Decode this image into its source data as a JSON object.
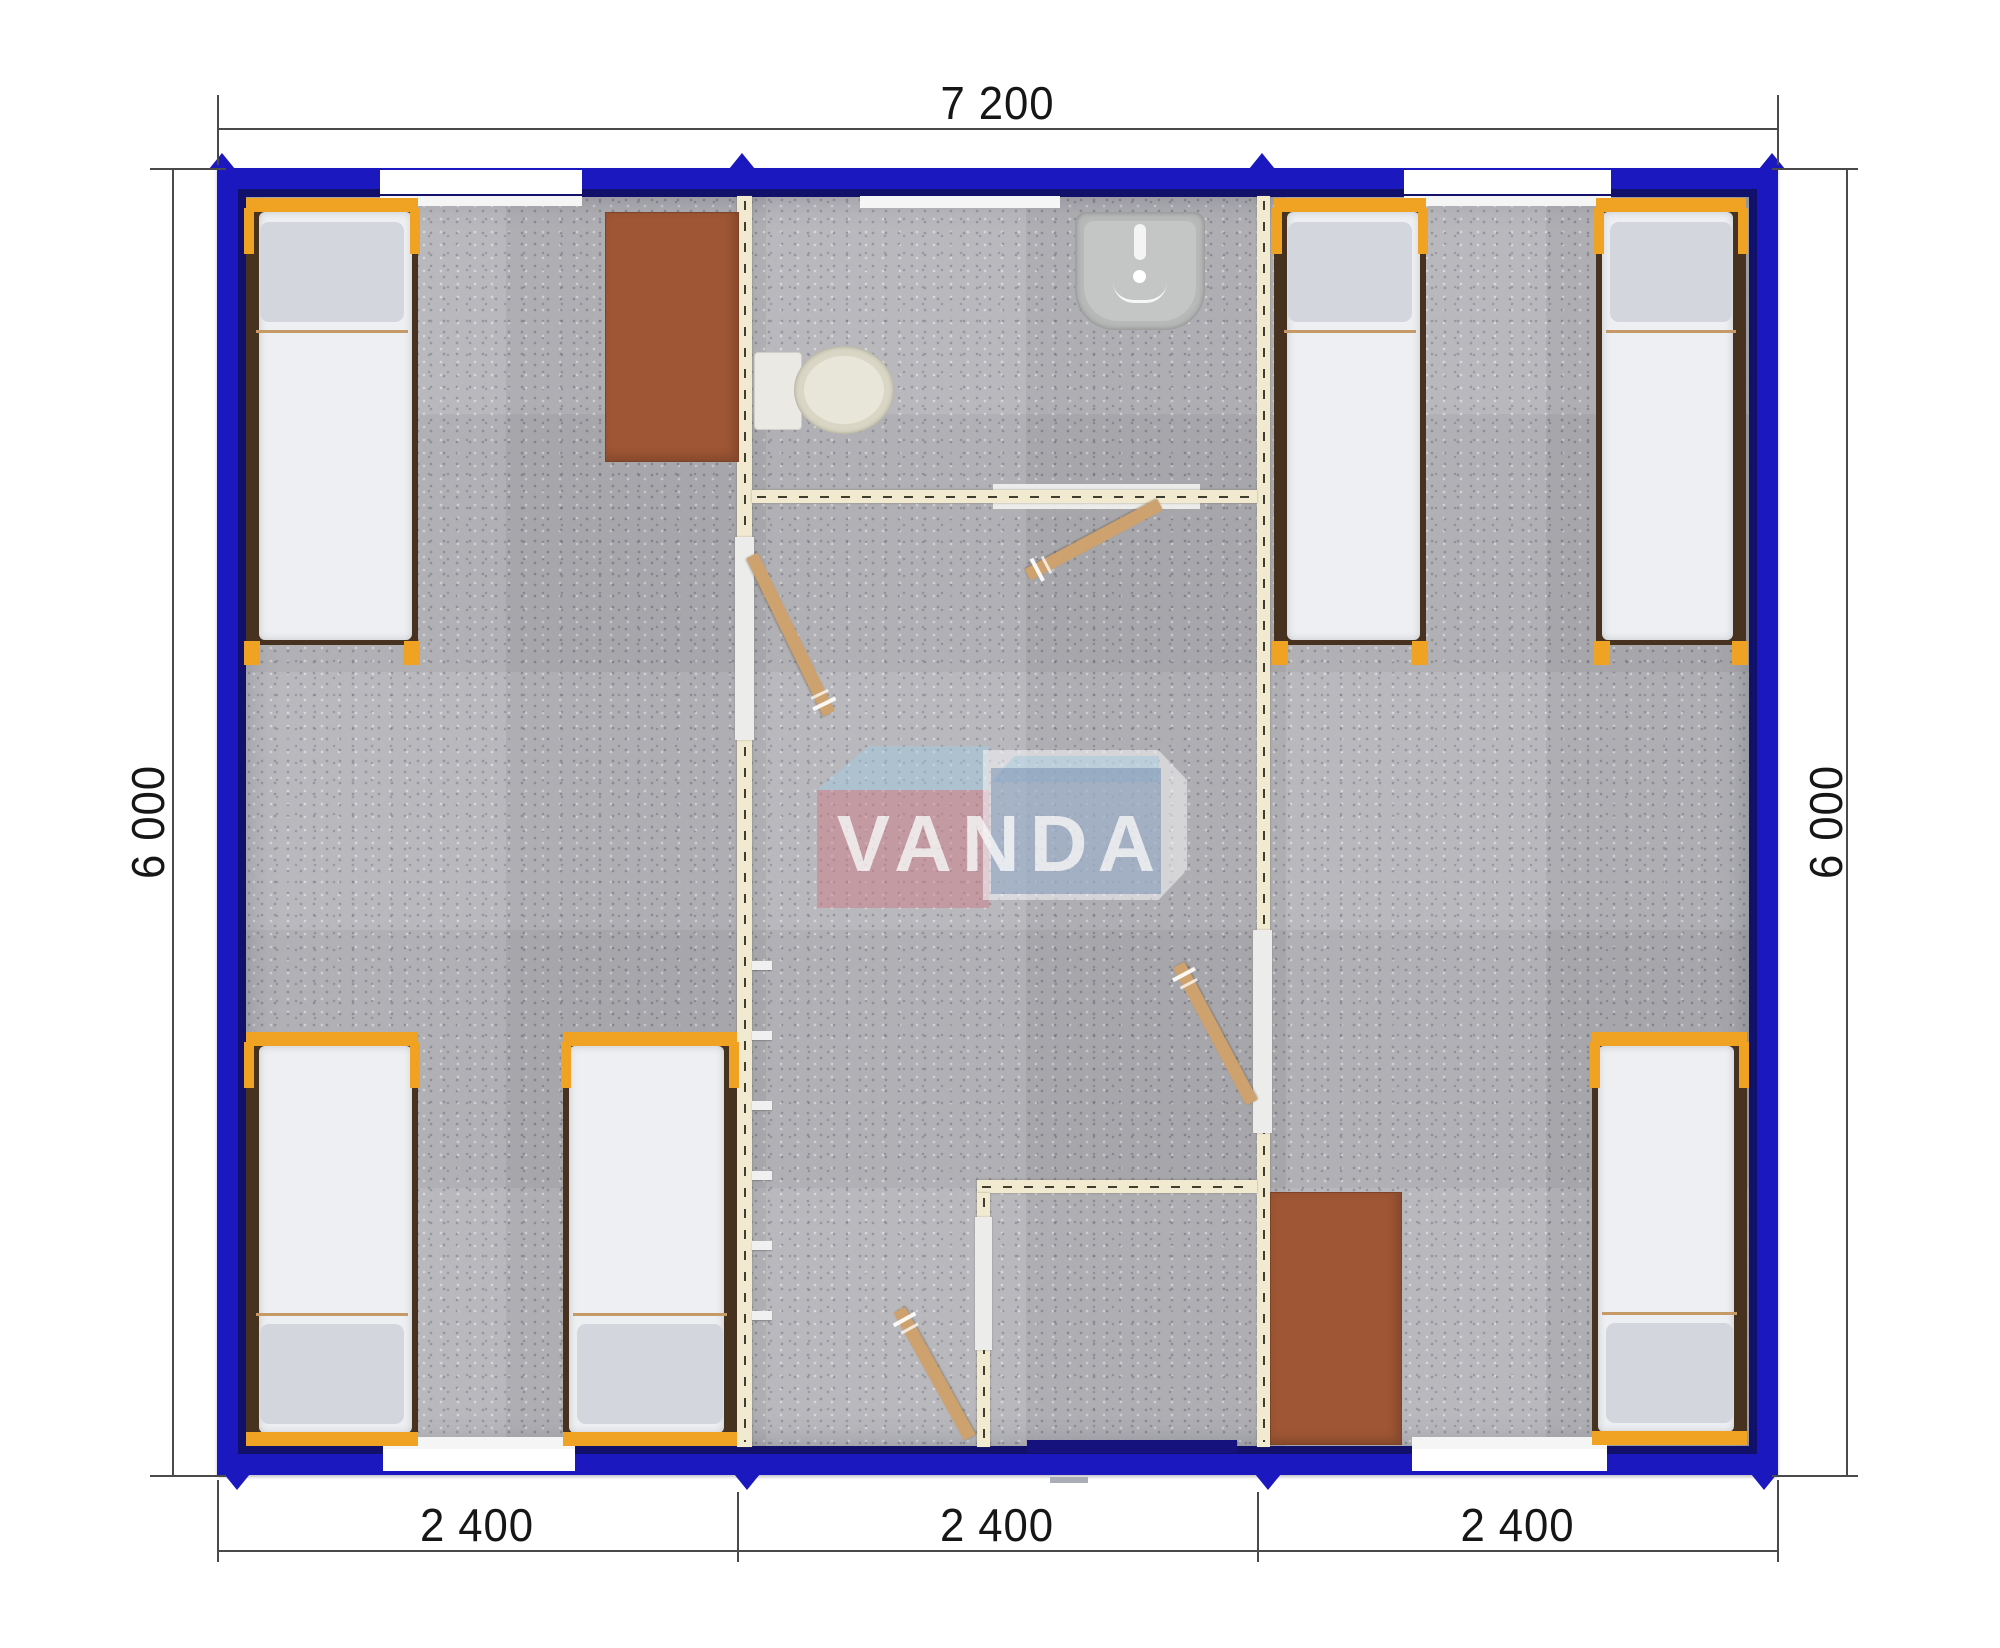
{
  "dimensions": {
    "top": "7 200",
    "left": "6 000",
    "right": "6 000",
    "bottom": [
      "2 400",
      "2 400",
      "2 400"
    ]
  },
  "logo": {
    "text": "VANDA"
  },
  "colors": {
    "border-blue": "#1b18c0",
    "border-dark": "#11106b",
    "floor-gray": "#b2b2b7",
    "wall-cream": "#f1ead1",
    "wall-dash": "#3f3d2e",
    "jamb-white": "#ececea",
    "wood-door": "#cda26e",
    "frame-orange": "#f0a322",
    "bed-dark": "#46321f",
    "mattress": "#edeff2",
    "pillow": "#d3d6dd",
    "table-brown": "#9e5634",
    "toilet-white": "#eae9e3",
    "bowl-beige": "#d9d6c5",
    "sink-gray": "#b6b9b8",
    "navy-door": "#15127d",
    "step-gray": "#a9aeb6",
    "dim-line": "#4a4a4a",
    "dim-text": "#161616",
    "logo-pink": "rgba(206,124,137,0.6)",
    "logo-blue": "rgba(124,150,184,0.62)",
    "logo-lightblue": "rgba(160,205,227,0.5)",
    "logo-white": "rgba(248,249,252,0.6)"
  },
  "plan": {
    "x": 217,
    "y": 168,
    "w": 1561,
    "h": 1307,
    "border": 29,
    "notches": {
      "top": [
        222,
        742,
        1262,
        1772
      ],
      "bottom": [
        237,
        747,
        1268,
        1764
      ]
    },
    "elements": [
      {
        "kind": "wallV",
        "name": "partition-wall-left",
        "x": 737,
        "y": 196,
        "w": 15,
        "h": 1251
      },
      {
        "kind": "wallV",
        "name": "partition-wall-right",
        "x": 1257,
        "y": 196,
        "w": 13,
        "h": 1251
      },
      {
        "kind": "wallH",
        "name": "bathroom-wall",
        "x": 752,
        "y": 490,
        "w": 505,
        "h": 13
      },
      {
        "kind": "wallH",
        "name": "vestibule-wall-front",
        "x": 977,
        "y": 1180,
        "w": 280,
        "h": 13
      },
      {
        "kind": "wallV",
        "name": "vestibule-wall-side",
        "x": 977,
        "y": 1193,
        "w": 13,
        "h": 254
      },
      {
        "kind": "panel",
        "name": "bathroom-sliding-door",
        "x": 993,
        "y": 484,
        "w": 207,
        "h": 25
      },
      {
        "kind": "jamb",
        "name": "door-opening-left-room",
        "x": 735,
        "y": 537,
        "w": 19,
        "h": 203
      },
      {
        "kind": "jamb",
        "name": "door-opening-right-room",
        "x": 1253,
        "y": 930,
        "w": 19,
        "h": 203
      },
      {
        "kind": "jamb",
        "name": "door-opening-vestibule",
        "x": 975,
        "y": 1217,
        "w": 17,
        "h": 133
      },
      {
        "kind": "window",
        "name": "window-top-left",
        "x": 380,
        "y": 170,
        "w": 202,
        "h": 24
      },
      {
        "kind": "sill",
        "name": "sill-top-left",
        "x": 380,
        "y": 196,
        "w": 202,
        "h": 10
      },
      {
        "kind": "window",
        "name": "window-top-right",
        "x": 1404,
        "y": 170,
        "w": 207,
        "h": 24
      },
      {
        "kind": "sill",
        "name": "sill-top-right",
        "x": 1404,
        "y": 196,
        "w": 207,
        "h": 10
      },
      {
        "kind": "sill",
        "name": "sill-bathroom",
        "x": 860,
        "y": 196,
        "w": 200,
        "h": 12
      },
      {
        "kind": "sill",
        "name": "sill-bottom-left",
        "x": 383,
        "y": 1437,
        "w": 192,
        "h": 12
      },
      {
        "kind": "window",
        "name": "window-bottom-left",
        "x": 383,
        "y": 1449,
        "w": 192,
        "h": 22
      },
      {
        "kind": "sill",
        "name": "sill-bottom-right",
        "x": 1412,
        "y": 1437,
        "w": 195,
        "h": 12
      },
      {
        "kind": "window",
        "name": "window-bottom-right",
        "x": 1412,
        "y": 1449,
        "w": 195,
        "h": 22
      },
      {
        "kind": "hook",
        "name": "wall-hook",
        "x": 752,
        "y": 961,
        "w": 20,
        "h": 9
      },
      {
        "kind": "hook",
        "name": "wall-hook",
        "x": 752,
        "y": 1031,
        "w": 20,
        "h": 9
      },
      {
        "kind": "hook",
        "name": "wall-hook",
        "x": 752,
        "y": 1101,
        "w": 20,
        "h": 9
      },
      {
        "kind": "hook",
        "name": "wall-hook",
        "x": 752,
        "y": 1171,
        "w": 20,
        "h": 9
      },
      {
        "kind": "hook",
        "name": "wall-hook",
        "x": 752,
        "y": 1241,
        "w": 20,
        "h": 9
      },
      {
        "kind": "hook",
        "name": "wall-hook",
        "x": 752,
        "y": 1311,
        "w": 20,
        "h": 9
      },
      {
        "kind": "door",
        "name": "door-left-room",
        "x": 752,
        "y": 555,
        "len": 176,
        "angle": 64
      },
      {
        "kind": "door",
        "name": "door-bathroom",
        "x": 1160,
        "y": 504,
        "len": 150,
        "angle": 152
      },
      {
        "kind": "door",
        "name": "door-right-room",
        "x": 1252,
        "y": 1102,
        "len": 156,
        "angle": 242
      },
      {
        "kind": "door",
        "name": "door-entry",
        "x": 970,
        "y": 1437,
        "len": 146,
        "angle": 241
      },
      {
        "kind": "bed",
        "name": "bed-left-top",
        "x": 246,
        "y": 198,
        "w": 172,
        "h": 447,
        "pillow": "top",
        "edge": "left"
      },
      {
        "kind": "bed",
        "name": "bed-left-bottom-1",
        "x": 246,
        "y": 1032,
        "w": 172,
        "h": 414,
        "pillow": "bottom",
        "edge": "left",
        "footbar": true
      },
      {
        "kind": "bed",
        "name": "bed-left-bottom-2",
        "x": 563,
        "y": 1032,
        "w": 174,
        "h": 414,
        "pillow": "bottom",
        "edge": "right",
        "footbar": true
      },
      {
        "kind": "bed",
        "name": "bed-right-top-1",
        "x": 1274,
        "y": 198,
        "w": 152,
        "h": 447,
        "pillow": "top",
        "edge": "left"
      },
      {
        "kind": "bed",
        "name": "bed-right-top-2",
        "x": 1596,
        "y": 198,
        "w": 150,
        "h": 447,
        "pillow": "top",
        "edge": "right"
      },
      {
        "kind": "bed",
        "name": "bed-right-bottom",
        "x": 1592,
        "y": 1032,
        "w": 155,
        "h": 413,
        "pillow": "bottom",
        "edge": "right",
        "footbar": true
      },
      {
        "kind": "table",
        "name": "desk-left-room",
        "x": 605,
        "y": 212,
        "w": 132,
        "h": 248
      },
      {
        "kind": "table",
        "name": "desk-right-room",
        "x": 1270,
        "y": 1192,
        "w": 130,
        "h": 251
      },
      {
        "kind": "toilet",
        "name": "toilet",
        "x": 754,
        "y": 346,
        "w": 142,
        "h": 88
      },
      {
        "kind": "sink",
        "name": "washbasin",
        "x": 1075,
        "y": 212,
        "w": 130,
        "h": 118
      },
      {
        "kind": "leaf",
        "name": "entry-door-leaf",
        "x": 1027,
        "y": 1440,
        "w": 210,
        "h": 13
      },
      {
        "kind": "step",
        "name": "entry-step",
        "x": 1050,
        "y": 1477,
        "w": 38,
        "h": 6
      }
    ]
  },
  "annotation_lines": [
    {
      "name": "dim-line-top",
      "x": 217,
      "y": 128,
      "w": 1561,
      "h": 2
    },
    {
      "name": "dim-line-bottom",
      "x": 217,
      "y": 1550,
      "w": 1561,
      "h": 2
    },
    {
      "name": "dim-line-left",
      "x": 172,
      "y": 168,
      "w": 2,
      "h": 1307
    },
    {
      "name": "dim-line-right",
      "x": 1846,
      "y": 168,
      "w": 2,
      "h": 1307
    },
    {
      "name": "ext-top-left",
      "x": 217,
      "y": 95,
      "w": 2,
      "h": 70
    },
    {
      "name": "ext-top-right",
      "x": 1777,
      "y": 95,
      "w": 2,
      "h": 70
    },
    {
      "name": "ext-left-upper",
      "x": 150,
      "y": 168,
      "w": 76,
      "h": 2
    },
    {
      "name": "ext-left-lower",
      "x": 150,
      "y": 1475,
      "w": 76,
      "h": 2
    },
    {
      "name": "ext-right-upper",
      "x": 1772,
      "y": 168,
      "w": 86,
      "h": 2
    },
    {
      "name": "ext-right-lower",
      "x": 1772,
      "y": 1475,
      "w": 86,
      "h": 2
    },
    {
      "name": "ext-bottom-1",
      "x": 217,
      "y": 1480,
      "w": 2,
      "h": 82
    },
    {
      "name": "ext-bottom-2",
      "x": 737,
      "y": 1492,
      "w": 2,
      "h": 70
    },
    {
      "name": "ext-bottom-3",
      "x": 1257,
      "y": 1492,
      "w": 2,
      "h": 70
    },
    {
      "name": "ext-bottom-4",
      "x": 1777,
      "y": 1480,
      "w": 2,
      "h": 82
    }
  ]
}
